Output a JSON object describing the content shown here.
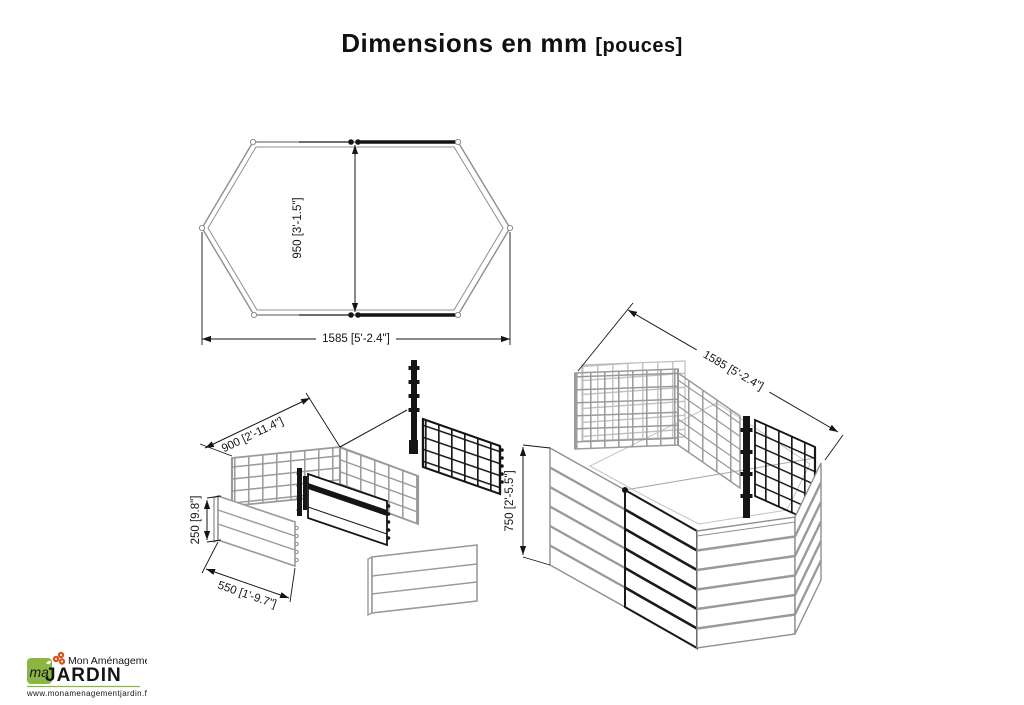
{
  "title": {
    "main": "Dimensions en mm",
    "bracket": "[pouces]"
  },
  "top_view": {
    "depth_label": "950 [3'-1.5\"]",
    "width_label": "1585 [5'-2.4\"]"
  },
  "exploded_view": {
    "grid_panel_width_label": "900 [2'-11.4\"]",
    "solid_panel_height_label": "250 [9.8\"]",
    "side_panel_width_label": "550 [1'-9.7\"]"
  },
  "assembled_view": {
    "width_label": "1585 [5'-2.4\"]",
    "height_label": "750 [2'-5.5\"]"
  },
  "logo": {
    "brand_top": "Mon Aménagement",
    "brand_main": "JARDIN",
    "logo_mark_letters": "ma",
    "website": "www.monamenagementjardin.fr",
    "orange": "#d4571c",
    "green": "#8cb643"
  }
}
